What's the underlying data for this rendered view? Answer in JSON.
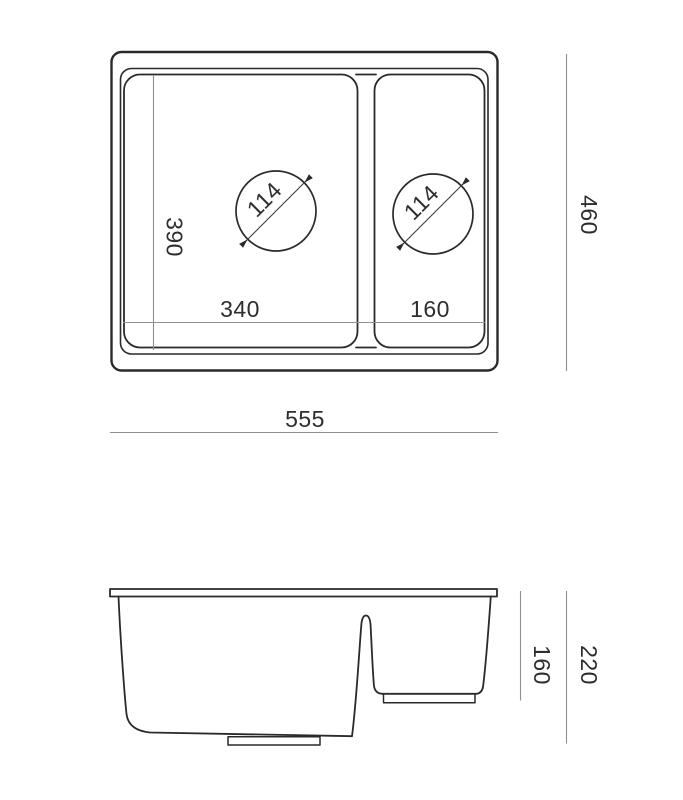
{
  "top_view": {
    "overall_width_label": "555",
    "overall_depth_label": "460",
    "bowl1_width_label": "340",
    "bowl1_depth_label": "390",
    "bowl2_width_label": "160",
    "bowl1_drain_diameter_label": "114",
    "bowl2_drain_diameter_label": "114"
  },
  "side_view": {
    "overall_height_label": "220",
    "bowl2_depth_label": "160"
  },
  "colors": {
    "outline": "#2a2a2a",
    "dimension_line": "#8f8f8f",
    "label_text": "#2e2e2e",
    "background": "#ffffff"
  }
}
